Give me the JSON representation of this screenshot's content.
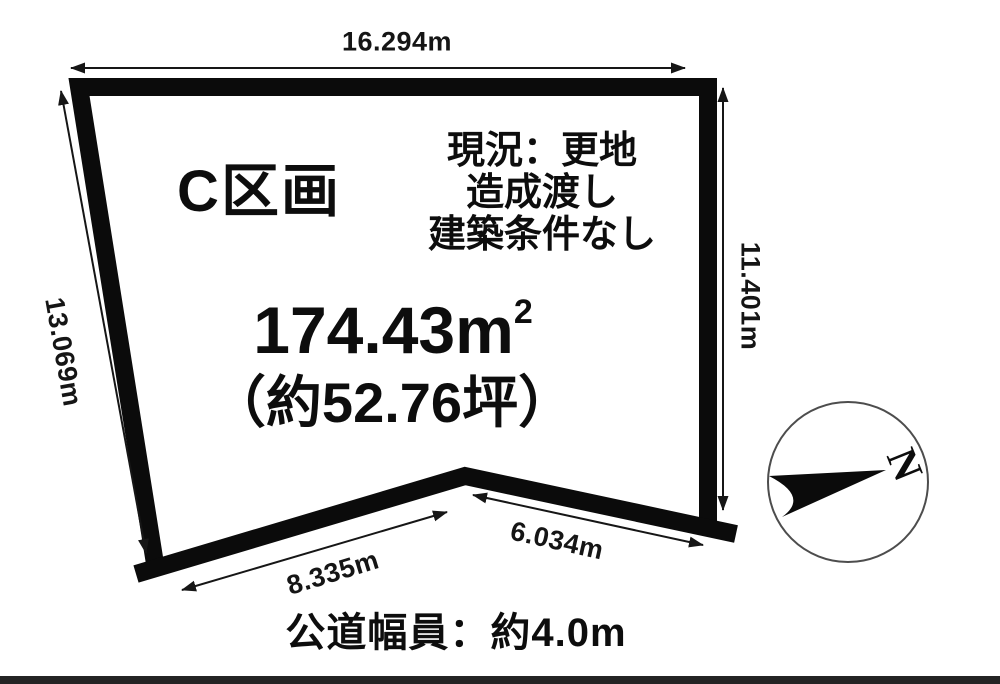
{
  "plot": {
    "label": "C区画",
    "area": {
      "value": "174.43m",
      "superscript": "2",
      "tsubo": "（約52.76坪）"
    },
    "conditions": [
      "現況：更地",
      "造成渡し",
      "建築条件なし"
    ],
    "road_note": "公道幅員：約4.0m",
    "dimensions": {
      "top": "16.294m",
      "left": "13.069m",
      "right": "11.401m",
      "bottom_left": "8.335m",
      "bottom_right": "6.034m"
    },
    "compass": {
      "north_label": "N"
    },
    "colors": {
      "boundary": "#0b0b0b",
      "dimension_line": "#161616",
      "compass_circle": "#4d4d4d",
      "background": "#ffffff"
    }
  }
}
